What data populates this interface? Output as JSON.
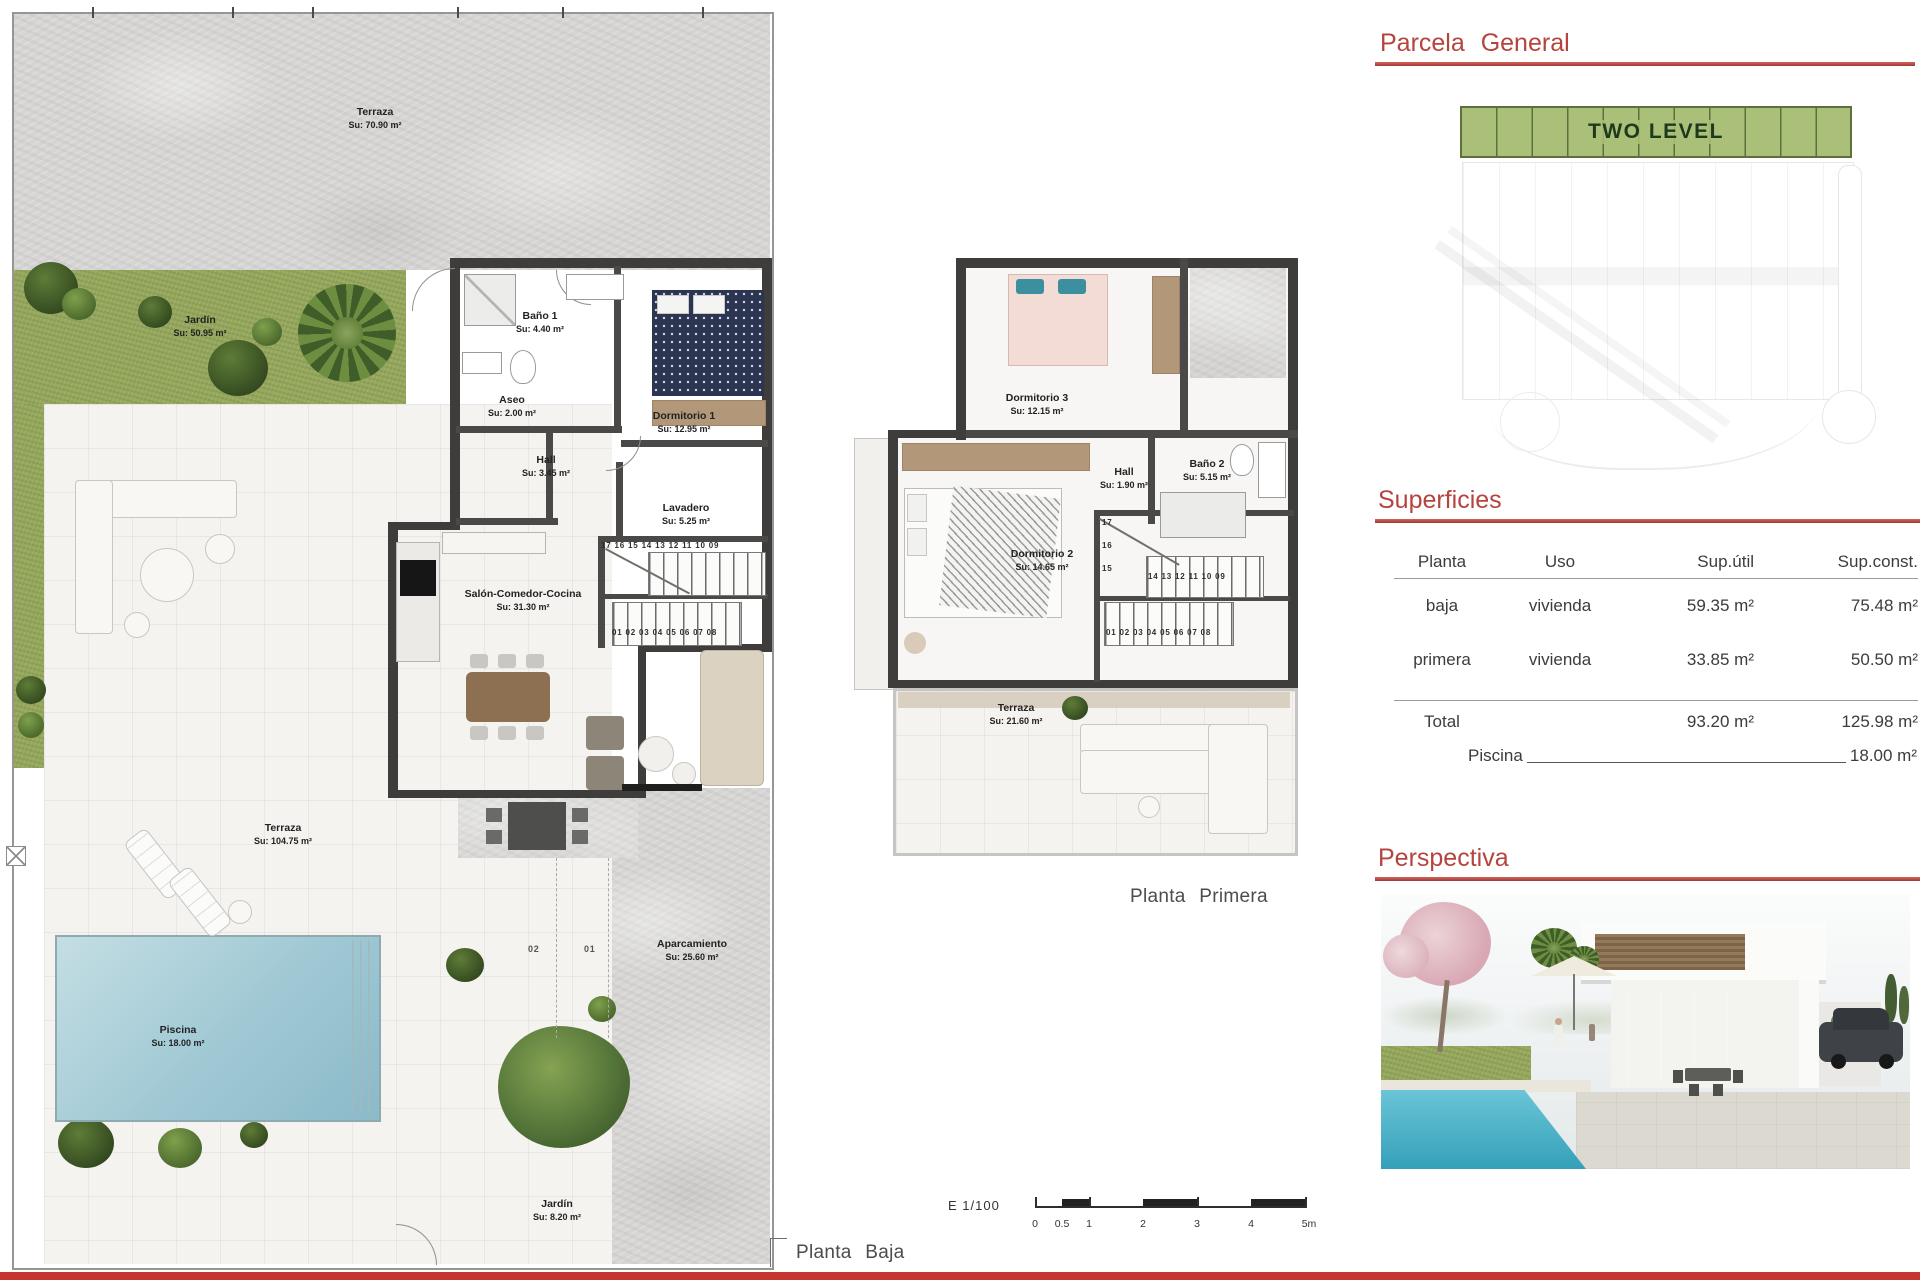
{
  "headings": {
    "parcela_general": "Parcela General",
    "superficies": "Superficies",
    "perspectiva": "Perspectiva"
  },
  "site_plan": {
    "band_label": "TWO LEVEL"
  },
  "surfaces_table": {
    "headers": [
      "Planta",
      "Uso",
      "Sup.útil",
      "Sup.const."
    ],
    "rows": [
      {
        "planta": "baja",
        "uso": "vivienda",
        "util": "59.35 m²",
        "const": "75.48 m²"
      },
      {
        "planta": "primera",
        "uso": "vivienda",
        "util": "33.85 m²",
        "const": "50.50 m²"
      }
    ],
    "total": {
      "label": "Total",
      "util": "93.20 m²",
      "const": "125.98 m²"
    },
    "piscina": {
      "label": "Piscina",
      "value": "18.00 m²"
    }
  },
  "ground_floor": {
    "caption": "Planta Baja",
    "rooms": {
      "terraza_top": {
        "name": "Terraza",
        "area": "Su: 70.90 m²"
      },
      "jardin": {
        "name": "Jardín",
        "area": "Su: 50.95 m²"
      },
      "bano1": {
        "name": "Baño 1",
        "area": "Su: 4.40 m²"
      },
      "aseo": {
        "name": "Aseo",
        "area": "Su: 2.00 m²"
      },
      "dormitorio1": {
        "name": "Dormitorio 1",
        "area": "Su: 12.95 m²"
      },
      "hall": {
        "name": "Hall",
        "area": "Su: 3.45 m²"
      },
      "lavadero": {
        "name": "Lavadero",
        "area": "Su: 5.25 m²"
      },
      "salon": {
        "name": "Salón-Comedor-Cocina",
        "area": "Su: 31.30 m²"
      },
      "terraza_main": {
        "name": "Terraza",
        "area": "Su: 104.75 m²"
      },
      "piscina": {
        "name": "Piscina",
        "area": "Su: 18.00 m²"
      },
      "aparcamiento": {
        "name": "Aparcamiento",
        "area": "Su: 25.60 m²"
      },
      "jardin_small": {
        "name": "Jardín",
        "area": "Su: 8.20 m²"
      }
    },
    "stairs": {
      "upper": "17 16 15 14 13 12 11 10 09",
      "lower": "01 02 03 04 05 06 07 08"
    },
    "parking_numbers": [
      "02",
      "01"
    ]
  },
  "first_floor": {
    "caption": "Planta Primera",
    "rooms": {
      "dormitorio3": {
        "name": "Dormitorio 3",
        "area": "Su: 12.15 m²"
      },
      "hall": {
        "name": "Hall",
        "area": "Su: 1.90 m²"
      },
      "bano2": {
        "name": "Baño 2",
        "area": "Su: 5.15 m²"
      },
      "dormitorio2": {
        "name": "Dormitorio 2",
        "area": "Su: 14.65 m²"
      },
      "terraza": {
        "name": "Terraza",
        "area": "Su: 21.60 m²"
      }
    },
    "stairs": {
      "vertical": [
        "17",
        "16",
        "15"
      ],
      "upper": "14 13 12 11 10 09",
      "lower": "01 02 03 04 05 06 07 08"
    }
  },
  "scale_bar": {
    "label": "E 1/100",
    "ticks": [
      "0",
      "0.5",
      "1",
      "2",
      "3",
      "4",
      "5m"
    ]
  }
}
